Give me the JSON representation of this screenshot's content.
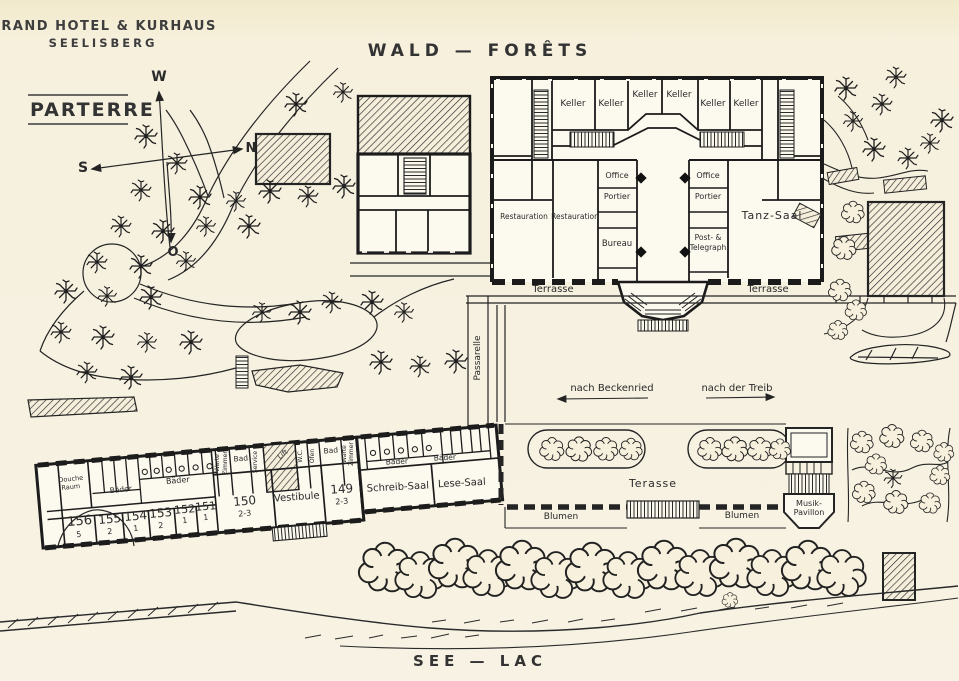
{
  "title": {
    "line1": "GRAND HOTEL & KURHAUS",
    "line2": "SEELISBERG"
  },
  "plan_label": "PARTERRE",
  "regions": {
    "top": "WALD — FORÊTS",
    "bottom": "SEE — LAC"
  },
  "colors": {
    "paper": "#f6f0dd",
    "ink": "#242424"
  },
  "labels": [
    {
      "name": "compass-w",
      "text": "W",
      "x": 159,
      "y": 81,
      "size": 14,
      "w": "bold"
    },
    {
      "name": "compass-n",
      "text": "N",
      "x": 251,
      "y": 152,
      "size": 13,
      "w": "bold"
    },
    {
      "name": "compass-s",
      "text": "S",
      "x": 83,
      "y": 172,
      "size": 14,
      "w": "bold"
    },
    {
      "name": "compass-o",
      "text": "O",
      "x": 173,
      "y": 256,
      "size": 13,
      "w": "bold"
    },
    {
      "name": "room-keller-1",
      "text": "Keller",
      "x": 573,
      "y": 106,
      "size": 9
    },
    {
      "name": "room-keller-2",
      "text": "Keller",
      "x": 611,
      "y": 106,
      "size": 9
    },
    {
      "name": "room-keller-3",
      "text": "Keller",
      "x": 645,
      "y": 97,
      "size": 9
    },
    {
      "name": "room-keller-4",
      "text": "Keller",
      "x": 679,
      "y": 97,
      "size": 9
    },
    {
      "name": "room-keller-5",
      "text": "Keller",
      "x": 713,
      "y": 106,
      "size": 9
    },
    {
      "name": "room-keller-6",
      "text": "Keller",
      "x": 746,
      "y": 106,
      "size": 9
    },
    {
      "name": "room-office-left",
      "text": "Office",
      "x": 617,
      "y": 178,
      "size": 8
    },
    {
      "name": "room-portier-left",
      "text": "Portier",
      "x": 617,
      "y": 199,
      "size": 8
    },
    {
      "name": "room-restauration-1",
      "text": "Restauration",
      "x": 524,
      "y": 219,
      "size": 7.5
    },
    {
      "name": "room-restauration-2",
      "text": "Restauration",
      "x": 575,
      "y": 219,
      "size": 7.5
    },
    {
      "name": "room-bureau",
      "text": "Bureau",
      "x": 617,
      "y": 246,
      "size": 8.5
    },
    {
      "name": "room-office-right",
      "text": "Office",
      "x": 708,
      "y": 178,
      "size": 8
    },
    {
      "name": "room-portier-right",
      "text": "Portier",
      "x": 708,
      "y": 199,
      "size": 8
    },
    {
      "name": "room-post-telegraph-1",
      "text": "Post- &",
      "x": 708,
      "y": 240,
      "size": 7.5
    },
    {
      "name": "room-post-telegraph-2",
      "text": "Telegraph",
      "x": 708,
      "y": 250,
      "size": 7.5
    },
    {
      "name": "room-tanz-saal",
      "text": "Tanz-Saal",
      "x": 772,
      "y": 219,
      "size": 11,
      "ls": 1
    },
    {
      "name": "terrasse-left",
      "text": "Terrasse",
      "x": 553,
      "y": 292,
      "size": 10
    },
    {
      "name": "terrasse-right",
      "text": "Terrasse",
      "x": 768,
      "y": 292,
      "size": 10
    },
    {
      "name": "passarelle",
      "text": "Passarelle",
      "x": 480,
      "y": 358,
      "size": 9,
      "rot": -90
    },
    {
      "name": "direction-beckenried",
      "text": "nach Beckenried",
      "x": 612,
      "y": 391,
      "size": 10
    },
    {
      "name": "direction-treib",
      "text": "nach der Treib",
      "x": 737,
      "y": 391,
      "size": 10
    },
    {
      "name": "room-156",
      "text": "156",
      "x": 80,
      "y": 525,
      "size": 13,
      "rot": -5
    },
    {
      "name": "room-156-cap",
      "text": "5",
      "x": 79,
      "y": 537,
      "size": 8,
      "rot": -5
    },
    {
      "name": "room-155",
      "text": "155",
      "x": 110,
      "y": 523,
      "size": 12,
      "rot": -5
    },
    {
      "name": "room-155-cap",
      "text": "2",
      "x": 110,
      "y": 534,
      "size": 8,
      "rot": -5
    },
    {
      "name": "room-154",
      "text": "154",
      "x": 136,
      "y": 520,
      "size": 12,
      "rot": -5
    },
    {
      "name": "room-154-cap",
      "text": "1",
      "x": 136,
      "y": 531,
      "size": 8,
      "rot": -5
    },
    {
      "name": "room-153",
      "text": "153",
      "x": 161,
      "y": 517,
      "size": 12,
      "rot": -5
    },
    {
      "name": "room-153-cap",
      "text": "2",
      "x": 161,
      "y": 528,
      "size": 8,
      "rot": -5
    },
    {
      "name": "room-152",
      "text": "152",
      "x": 185,
      "y": 513,
      "size": 11,
      "rot": -5
    },
    {
      "name": "room-152-cap",
      "text": "1",
      "x": 185,
      "y": 523,
      "size": 8,
      "rot": -5
    },
    {
      "name": "room-151",
      "text": "151",
      "x": 206,
      "y": 510,
      "size": 11,
      "rot": -5
    },
    {
      "name": "room-151-cap",
      "text": "1",
      "x": 206,
      "y": 520,
      "size": 8,
      "rot": -5
    },
    {
      "name": "room-150",
      "text": "150",
      "x": 245,
      "y": 505,
      "size": 12,
      "rot": -5
    },
    {
      "name": "room-150-cap",
      "text": "2-3",
      "x": 245,
      "y": 516,
      "size": 8,
      "rot": -5
    },
    {
      "name": "room-vestibule",
      "text": "Vestibule",
      "x": 297,
      "y": 500,
      "size": 10,
      "rot": -4
    },
    {
      "name": "room-149",
      "text": "149",
      "x": 342,
      "y": 493,
      "size": 12,
      "rot": -4
    },
    {
      "name": "room-149-cap",
      "text": "2-3",
      "x": 342,
      "y": 504,
      "size": 8,
      "rot": -4
    },
    {
      "name": "room-douche-1",
      "text": "Douche",
      "x": 71,
      "y": 481,
      "size": 6.5,
      "rot": -6
    },
    {
      "name": "room-douche-2",
      "text": "Raum",
      "x": 71,
      "y": 489,
      "size": 6.5,
      "rot": -6
    },
    {
      "name": "room-baeder-1",
      "text": "Bäder",
      "x": 121,
      "y": 492,
      "size": 7.5,
      "rot": -6
    },
    {
      "name": "room-baeder-2",
      "text": "Bäder",
      "x": 178,
      "y": 483,
      "size": 8,
      "rot": -5
    },
    {
      "name": "room-warte-1a",
      "text": "Warte",
      "x": 219,
      "y": 463,
      "size": 6,
      "rot": -90
    },
    {
      "name": "room-warte-1b",
      "text": "Zimmer",
      "x": 227,
      "y": 463,
      "size": 6,
      "rot": -90
    },
    {
      "name": "room-bad-1",
      "text": "Bad",
      "x": 241,
      "y": 461,
      "size": 7.5,
      "rot": -5
    },
    {
      "name": "room-service",
      "text": "Service",
      "x": 257,
      "y": 462,
      "size": 6,
      "rot": -90
    },
    {
      "name": "room-lift",
      "text": "Lift",
      "x": 284,
      "y": 456,
      "size": 7,
      "rot": -38
    },
    {
      "name": "room-wc",
      "text": "W.C.",
      "x": 302,
      "y": 456,
      "size": 6,
      "rot": -90
    },
    {
      "name": "room-ofen",
      "text": "Ofen",
      "x": 314,
      "y": 456,
      "size": 6,
      "rot": -90
    },
    {
      "name": "room-bad-2",
      "text": "Bad",
      "x": 331,
      "y": 453,
      "size": 7.5,
      "rot": -5
    },
    {
      "name": "room-warte-2a",
      "text": "Warte",
      "x": 346,
      "y": 454,
      "size": 6,
      "rot": -90
    },
    {
      "name": "room-warte-2b",
      "text": "Zimmer",
      "x": 353,
      "y": 454,
      "size": 6,
      "rot": -90
    },
    {
      "name": "room-baeder-3",
      "text": "Bäder",
      "x": 397,
      "y": 464,
      "size": 7.5,
      "rot": -3
    },
    {
      "name": "room-baeder-4",
      "text": "Bäder",
      "x": 445,
      "y": 460,
      "size": 7.5,
      "rot": -3
    },
    {
      "name": "room-schreib-saal",
      "text": "Schreib-Saal",
      "x": 398,
      "y": 490,
      "size": 10,
      "rot": -3
    },
    {
      "name": "room-lese-saal",
      "text": "Lese-Saal",
      "x": 462,
      "y": 486,
      "size": 10,
      "rot": -3
    },
    {
      "name": "terasse-lower",
      "text": "Terasse",
      "x": 653,
      "y": 487,
      "size": 11,
      "ls": 1
    },
    {
      "name": "blumen-left",
      "text": "Blumen",
      "x": 561,
      "y": 519,
      "size": 9
    },
    {
      "name": "blumen-right",
      "text": "Blumen",
      "x": 742,
      "y": 518,
      "size": 9
    },
    {
      "name": "musik-pavillon-1",
      "text": "Musik-",
      "x": 809,
      "y": 506,
      "size": 8
    },
    {
      "name": "musik-pavillon-2",
      "text": "Pavillon",
      "x": 809,
      "y": 515,
      "size": 8
    }
  ]
}
